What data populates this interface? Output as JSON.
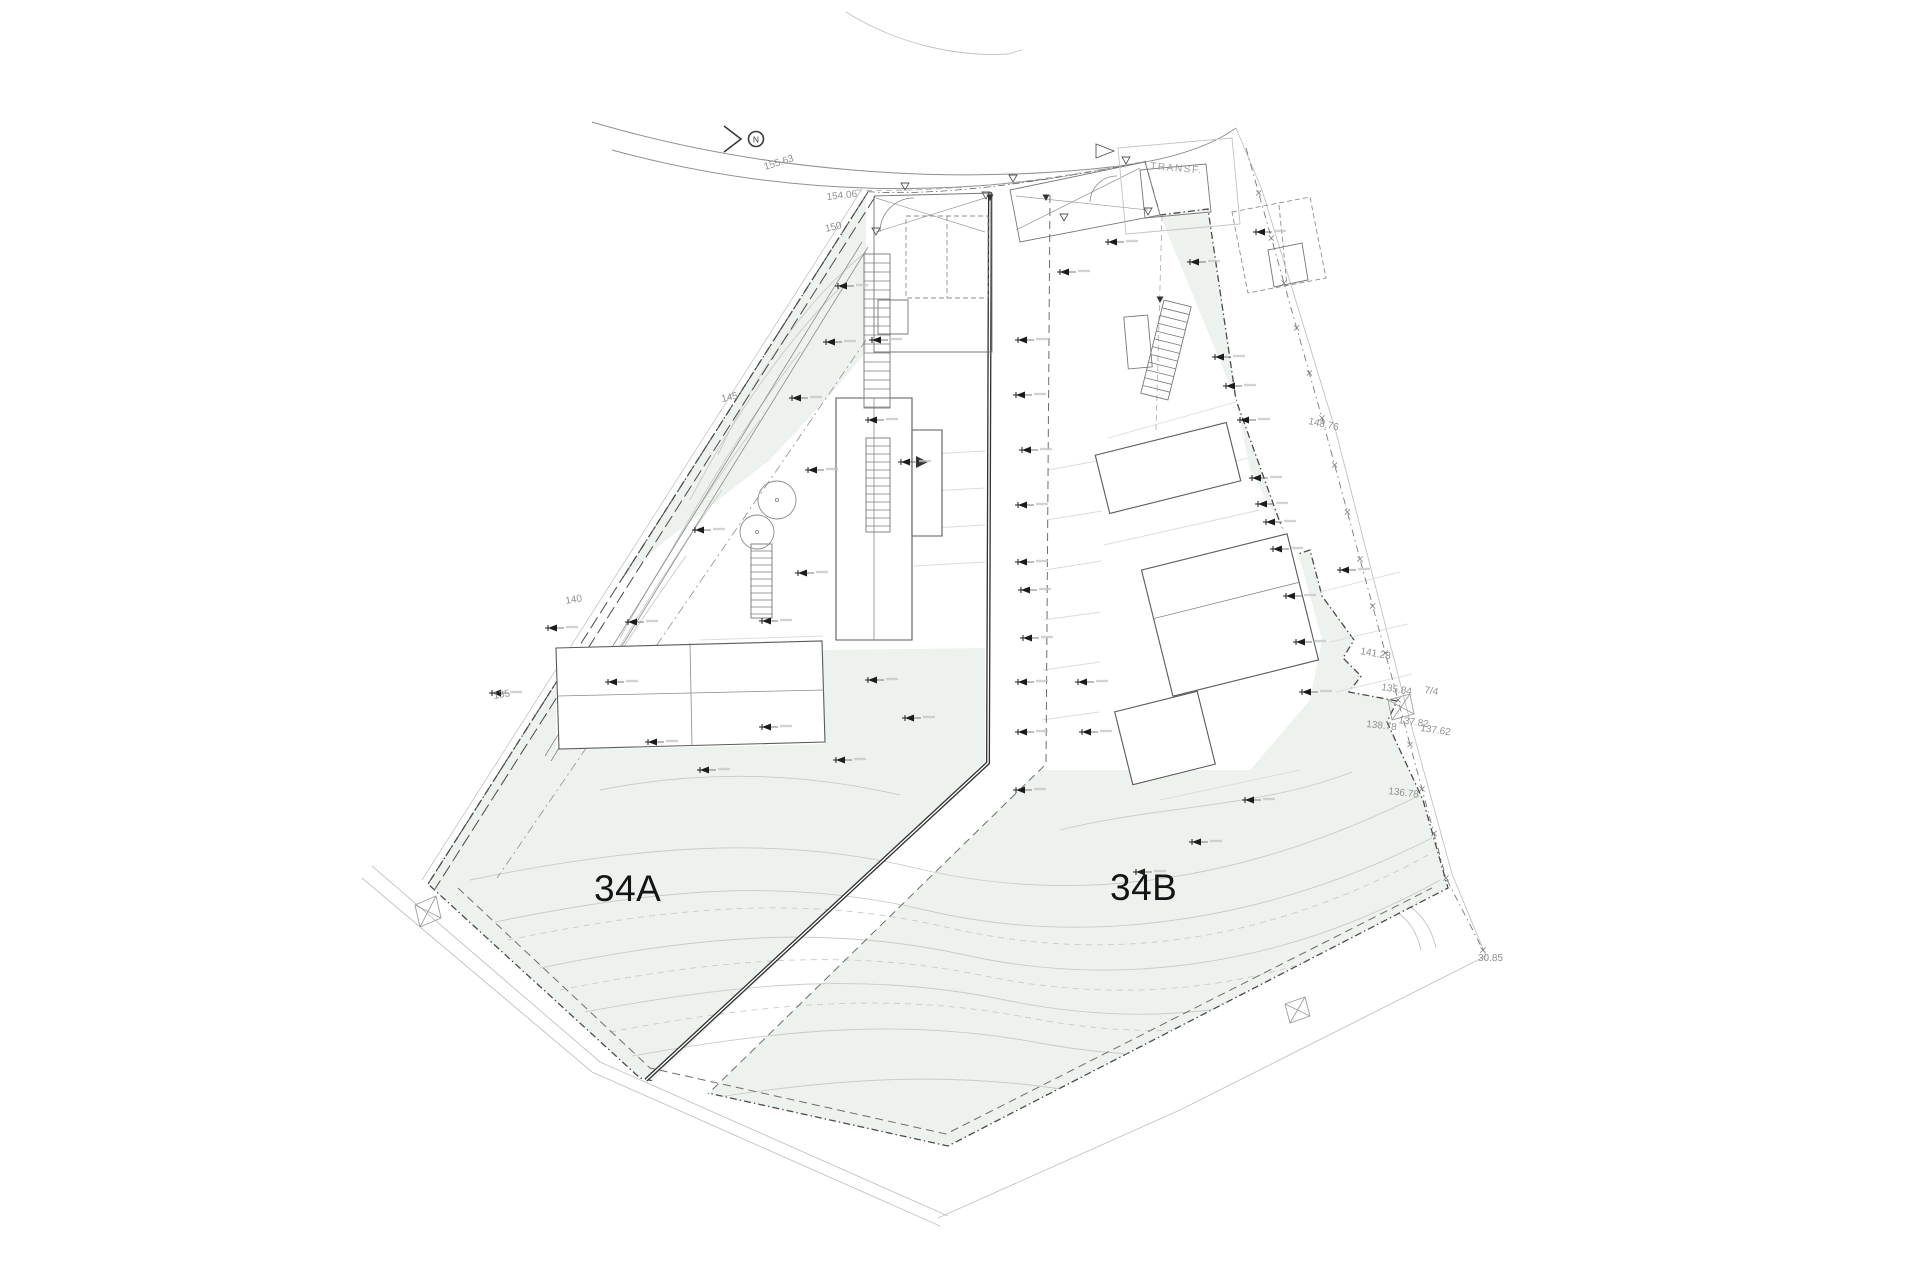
{
  "title": "Site plan — lots 34A and 34B",
  "labels": {
    "lot_a": "34A",
    "lot_b": "34B",
    "north": "N",
    "transformer": "TRANSF.",
    "road_upper": "155.63",
    "road_entry": "154.06",
    "contour_150": "150",
    "contour_145": "145",
    "contour_140": "140",
    "contour_135": "135",
    "fence_upper": "148.76",
    "fence_mid": "141.28",
    "corner_135_84": "135.84",
    "parcel_ref": "7/4",
    "corner_138_78": "138.78",
    "corner_137_82": "137.82",
    "corner_137_62": "137.62",
    "corner_136_78": "136.78",
    "corner_30_85": "30.85"
  },
  "colors": {
    "background": "#ffffff",
    "site_fill": "#eef2ee",
    "boundary_line": "#4a4a4a",
    "building_line": "#5a5a5a",
    "contour_line": "#c7ccc7",
    "terrace_line": "#d9ddd9",
    "road_line": "#8f8f8f",
    "marker_black": "#1c1c1c",
    "dim_text": "#8e938e",
    "lot_text": "#141414"
  }
}
